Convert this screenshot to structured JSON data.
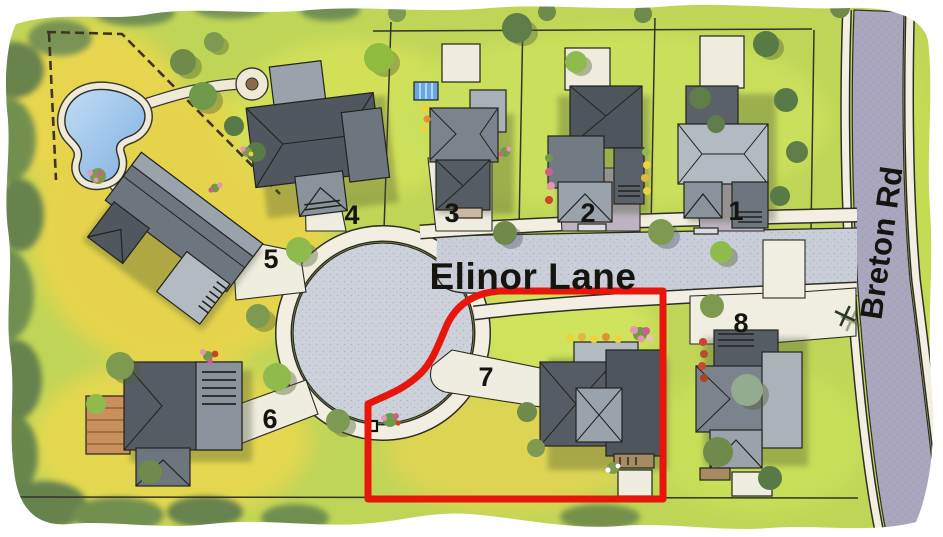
{
  "map": {
    "street": {
      "label": "Elinor Lane"
    },
    "main_road": {
      "label": "Breton Rd"
    },
    "lots": [
      {
        "number": "1"
      },
      {
        "number": "2"
      },
      {
        "number": "3"
      },
      {
        "number": "4"
      },
      {
        "number": "5"
      },
      {
        "number": "6"
      },
      {
        "number": "7"
      },
      {
        "number": "8"
      }
    ],
    "highlighted_lot": {
      "number": "7",
      "outline_color": "#e8150d"
    },
    "features": {
      "cul_de_sac": "cul-de-sac bulb",
      "pond": "pond",
      "mailbox": "mailbox-icon",
      "street_sign": "street-sign-icon"
    },
    "colors": {
      "street_surface": "#ccd1da",
      "main_road_surface": "#aaa6bd",
      "sidewalk": "#f2efe2",
      "driveway": "#beb3c3",
      "grass": "#c3d957",
      "pond_water": "#9cc2ea",
      "highlight_red": "#e8150d"
    }
  }
}
